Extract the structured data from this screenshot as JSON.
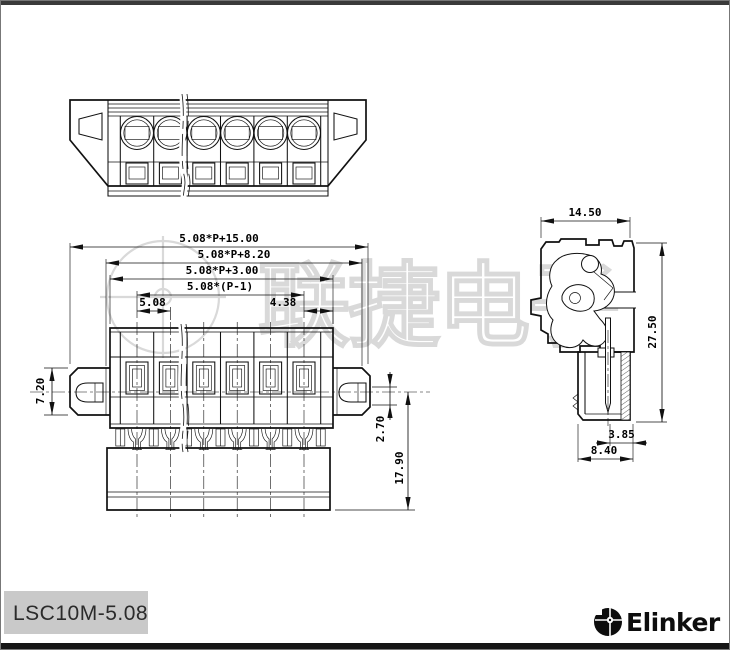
{
  "part_label": "LSC10M-5.08",
  "brand_logo_text": "Elinker",
  "watermark": {
    "char_1": "联",
    "char_2": "捷",
    "char_3": "电",
    "char_4": "子"
  },
  "pole_count_visible": 6,
  "dims": {
    "front": {
      "total_width": "5.08*P+15.00",
      "mounting_width": "5.08*P+8.20",
      "body_width": "5.08*P+3.00",
      "pole_span": "5.08*(P-1)",
      "pitch": "5.08",
      "end_offset": "4.38",
      "ear_height": "7.20",
      "slot_offset": "2.70",
      "total_height": "17.90"
    },
    "side": {
      "width": "14.50",
      "height": "27.50",
      "pin_inset": "3.85",
      "depth": "8.40"
    }
  },
  "colors": {
    "line": "#111111",
    "watermark": "#d9d9d9",
    "label_bg": "#c9c9c9",
    "top_bar": "#3a3a3a",
    "bottom_bar": "#161616"
  }
}
